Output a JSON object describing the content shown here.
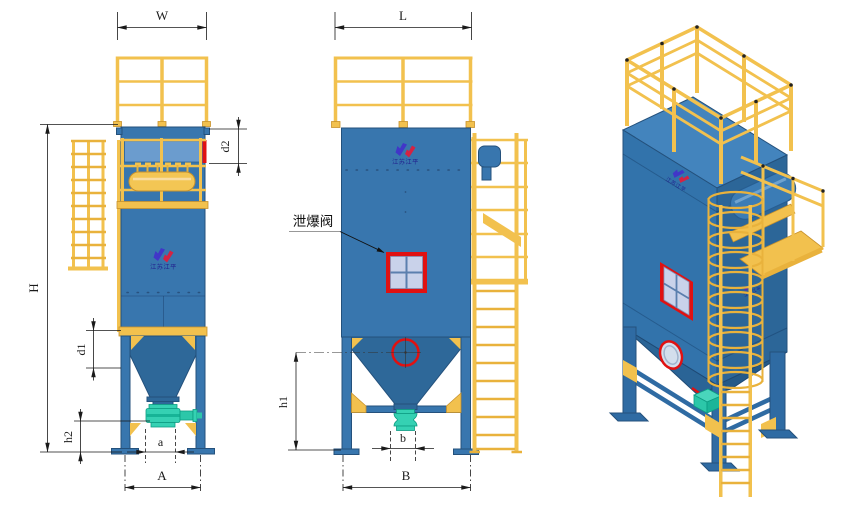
{
  "drawing": {
    "type": "dust-collector three-view engineering drawing",
    "views": [
      "front-view",
      "side-view",
      "isometric-view"
    ]
  },
  "labels": {
    "W": "W",
    "L": "L",
    "H": "H",
    "d1": "d1",
    "d2": "d2",
    "h1": "h1",
    "h2": "h2",
    "a": "a",
    "b": "b",
    "A": "A",
    "B": "B",
    "explosion_vent": "泄爆阀"
  },
  "brand": {
    "logo_text": "江苏江平"
  },
  "colors": {
    "body_blue": "#3876AE",
    "roof_blue": "#4384BD",
    "hopper_blue": "#2E6899",
    "line_dark": "#24517C",
    "yellow": "#F2C14E",
    "yellow_deep": "#E9B23C",
    "yellow_dark": "#C8922C",
    "teal": "#35D1B3",
    "teal_dark": "#0D9C82",
    "red": "#E01111",
    "pane": "#C9D2EA",
    "pane_line": "#5B7FAE",
    "logo_blue": "#4136C8",
    "logo_red": "#D42343",
    "logo_text": "#22228F",
    "dim": "#1A1A1A"
  }
}
